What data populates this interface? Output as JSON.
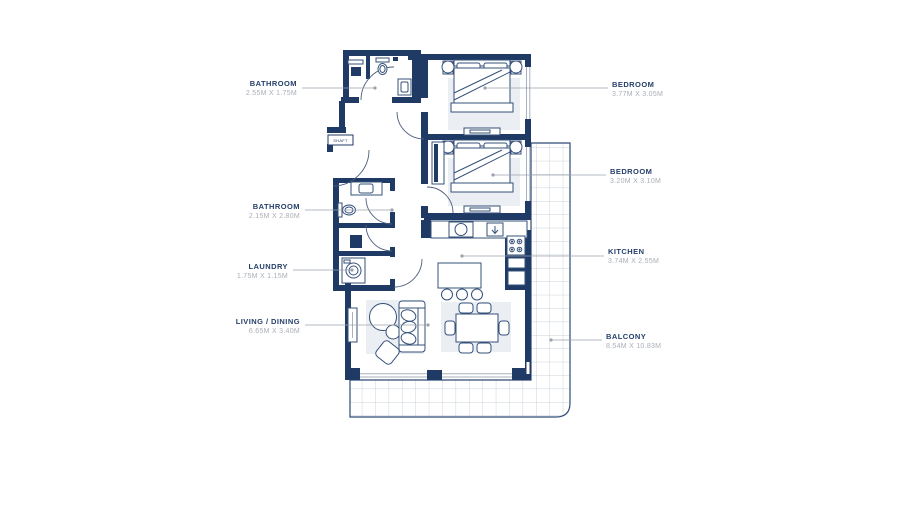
{
  "plan": {
    "shaft_label": "SHAFT",
    "rooms": [
      {
        "id": "bathroom-1",
        "name": "BATHROOM",
        "dims": "2.55M X 1.75M"
      },
      {
        "id": "bedroom-1",
        "name": "BEDROOM",
        "dims": "3.77M X 3.05M"
      },
      {
        "id": "bedroom-2",
        "name": "BEDROOM",
        "dims": "3.20M X 3.10M"
      },
      {
        "id": "bathroom-2",
        "name": "BATHROOM",
        "dims": "2.15M X 2.80M"
      },
      {
        "id": "kitchen",
        "name": "KITCHEN",
        "dims": "3.74M X 2.55M"
      },
      {
        "id": "laundry",
        "name": "LAUNDRY",
        "dims": "1.75M X 1.15M"
      },
      {
        "id": "living-dining",
        "name": "LIVING / DINING",
        "dims": "6.65M X 3.40M"
      },
      {
        "id": "balcony",
        "name": "BALCONY",
        "dims": "8.54M X 10.83M"
      }
    ],
    "colors": {
      "wall": "#203a66",
      "leader": "#9aa2ac",
      "label_text": "#25406b",
      "dims_text": "#a9aeb7",
      "balcony_grid": "#cdd3da",
      "rug": "#ebeef2"
    }
  }
}
